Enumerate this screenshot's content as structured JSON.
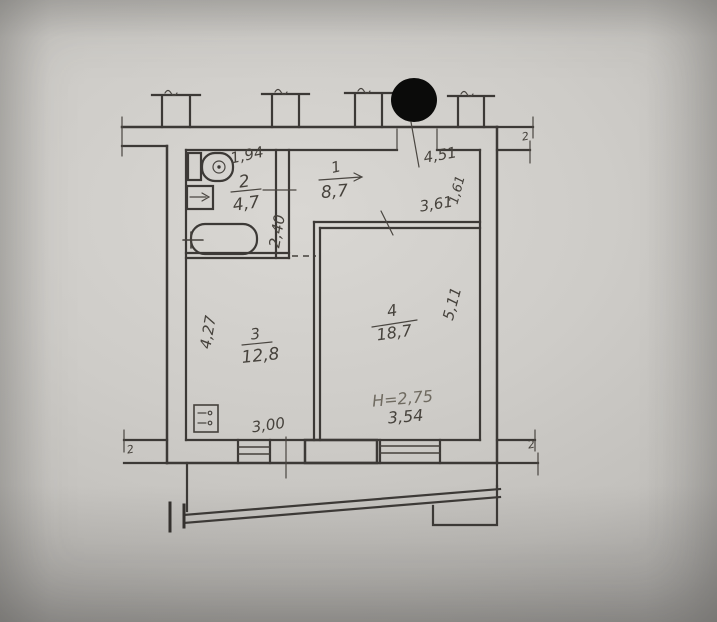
{
  "plan": {
    "title": "apartment-floor-plan",
    "rooms": [
      {
        "number": "1",
        "area": "8,7"
      },
      {
        "number": "2",
        "area": "4,7"
      },
      {
        "number": "3",
        "area": "12,8"
      },
      {
        "number": "4",
        "area": "18,7"
      }
    ],
    "dimensions": {
      "bath_top_width": "1,94",
      "bath_depth": "2,40",
      "hall_width": "4,51",
      "hall_depth": "1,61",
      "room4_top_width": "3,61",
      "room4_right_depth": "5,11",
      "room4_bottom_width": "3,54",
      "room3_left_depth": "4,27",
      "room3_bottom_width": "3,00",
      "ceiling_height": "H=2,75"
    },
    "break_marks": {
      "top_right": "2",
      "bottom_right": "2",
      "bottom_left": "2"
    },
    "fixtures": [
      "toilet",
      "sink",
      "bathtub",
      "electric-stove"
    ],
    "colors": {
      "ink": "#3c3936",
      "pencil": "#6f6a60",
      "paper": "#ceccc8",
      "blackout": "#0b0b0a"
    }
  }
}
